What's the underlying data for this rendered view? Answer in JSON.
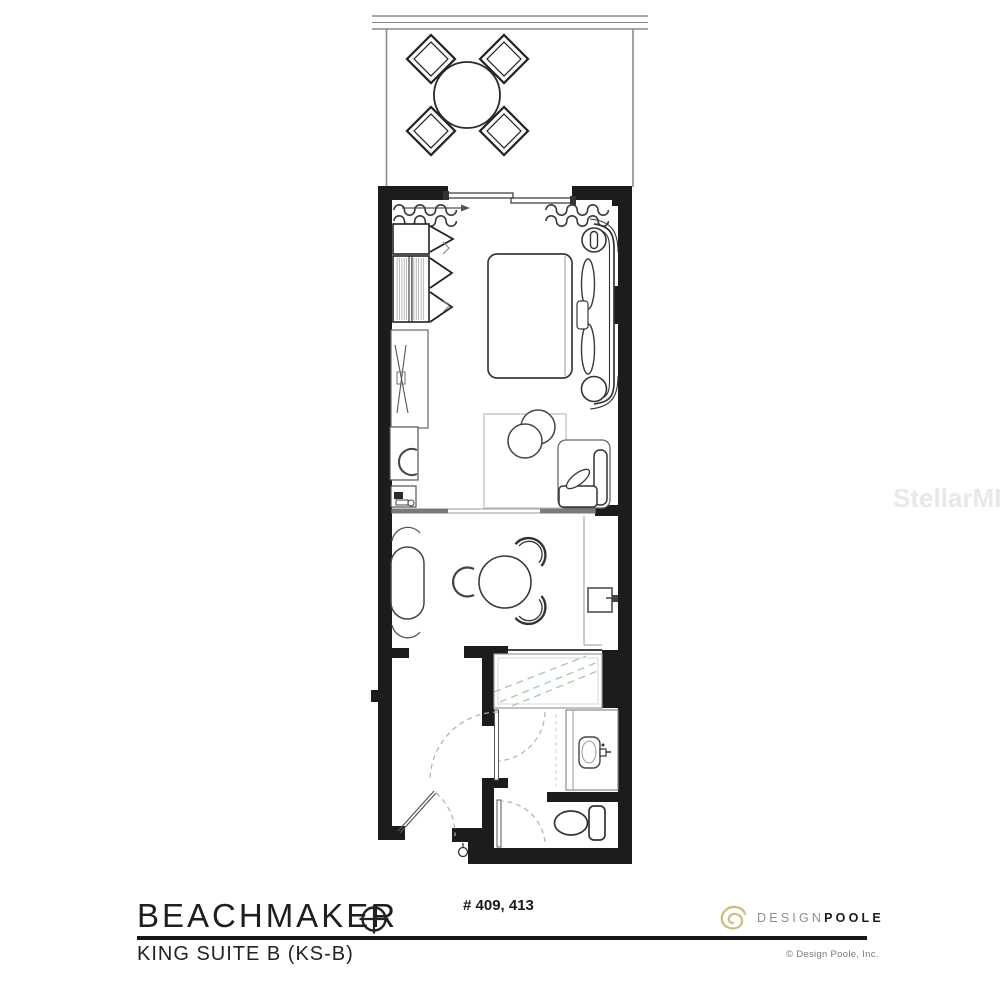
{
  "page": {
    "background": "#ffffff"
  },
  "watermark": {
    "text": "StellarMLS"
  },
  "title_block": {
    "property_name": "BEACHMAKER",
    "plan_name": "KING SUITE B (KS-B)",
    "unit_numbers": "# 409, 413",
    "logo": {
      "design": "DESIGN",
      "poole": "POOLE"
    },
    "copyright": "© Design Poole, Inc."
  },
  "colors": {
    "wall": "#1c1c1c",
    "furniture_line": "#333333",
    "light_line": "#999999",
    "glass_green": "#9cc49c",
    "logo_gold": "#cbbd7e",
    "logo_gray": "#8f8f8f",
    "text": "#1f1f1f",
    "watermark": "#e8e8e8"
  },
  "floor_plan": {
    "rooms": [
      "balcony",
      "bedroom",
      "sitting-area",
      "bathroom",
      "entry"
    ],
    "furniture": [
      "balcony-round-table",
      "balcony-chairs",
      "sliding-glass-door",
      "curtains",
      "closet",
      "tv-console",
      "desk",
      "desk-chair",
      "coffee-station",
      "king-bed",
      "nightstand-lamps",
      "rug",
      "ottoman",
      "armchair",
      "chaise",
      "dining-table",
      "dining-chairs",
      "wall-mounted-box",
      "shower",
      "vanity-sink",
      "toilet",
      "entry-door"
    ]
  }
}
